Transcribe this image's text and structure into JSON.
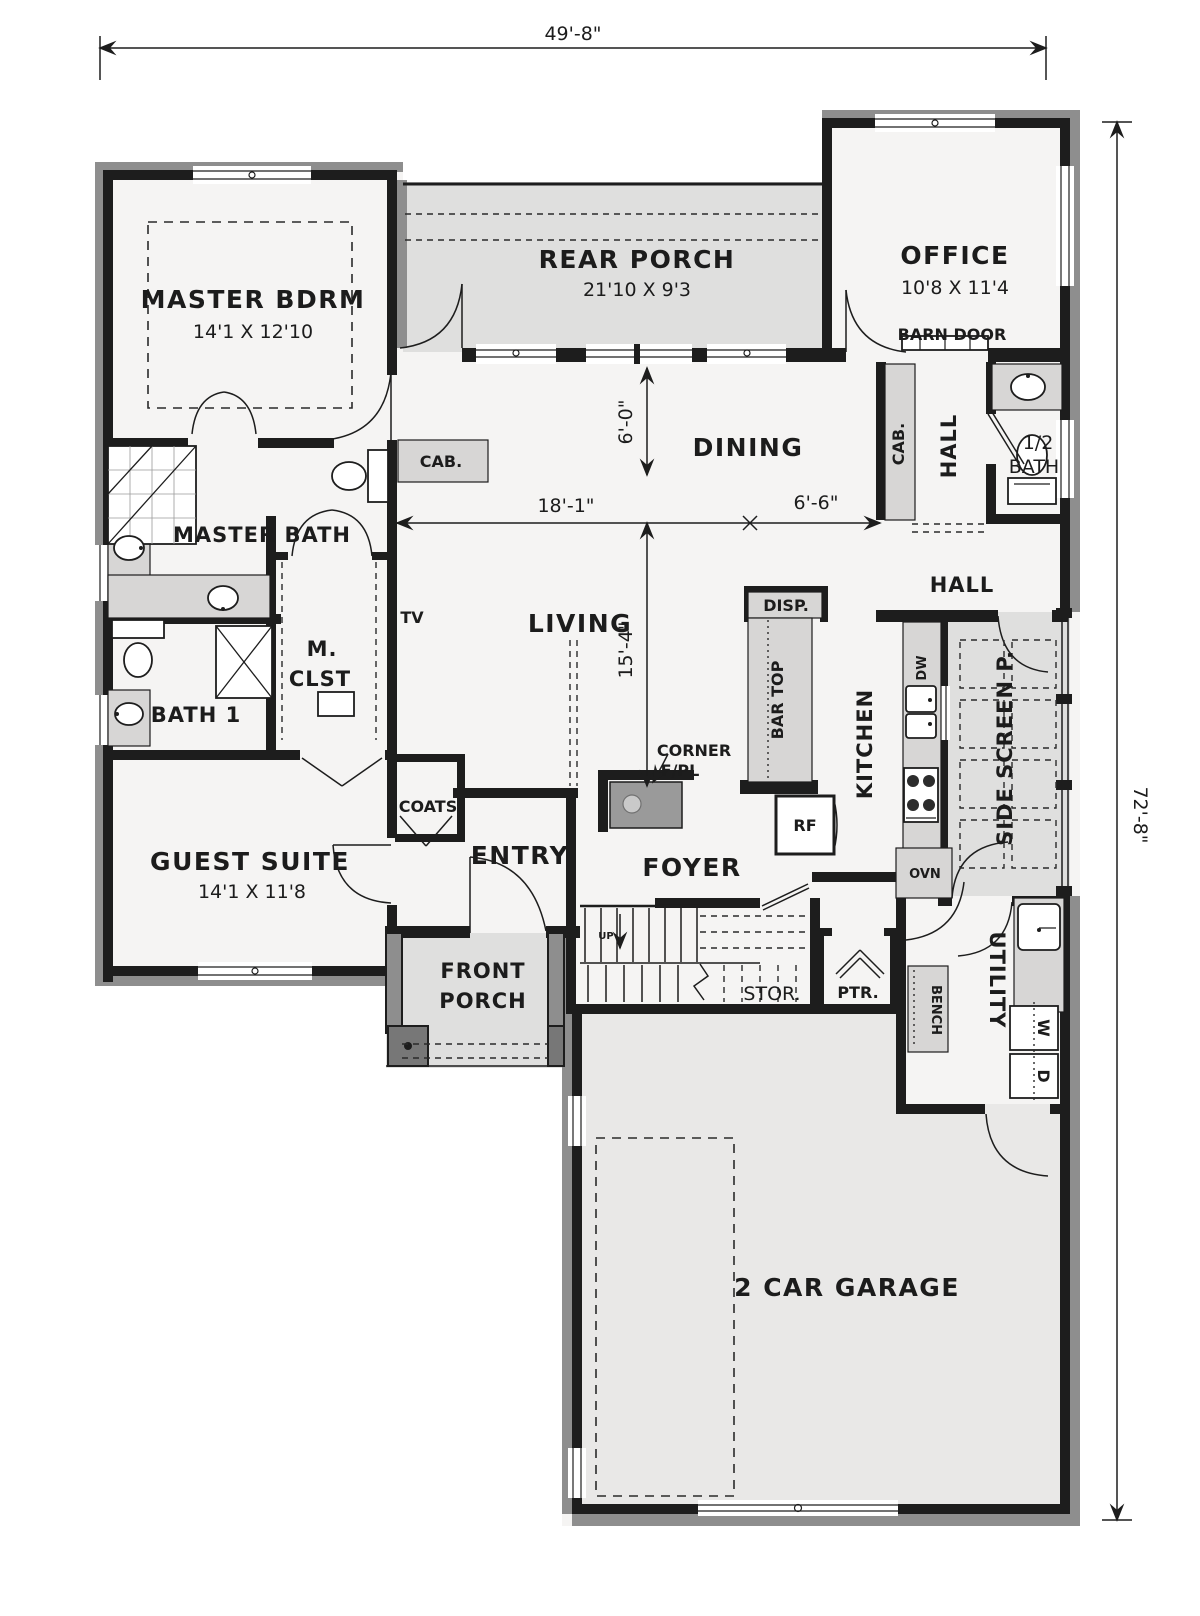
{
  "plan": {
    "dims": {
      "overall_width": "49'-8\"",
      "overall_height": "72'-8\"",
      "dining_depth": "6'-0\"",
      "living_width": "18'-1\"",
      "dining_width": "6'-6\"",
      "living_depth": "15'-4\""
    },
    "rooms": {
      "master_bdrm": {
        "name": "MASTER BDRM",
        "size": "14'1 X 12'10"
      },
      "rear_porch": {
        "name": "REAR PORCH",
        "size": "21'10 X 9'3"
      },
      "office": {
        "name": "OFFICE",
        "size": "10'8 X 11'4"
      },
      "master_bath": {
        "name": "MASTER BATH"
      },
      "master_closet": {
        "line1": "M.",
        "line2": "CLST"
      },
      "bath_1": {
        "name": "BATH 1"
      },
      "guest_suite": {
        "name": "GUEST SUITE",
        "size": "14'1 X 11'8"
      },
      "dining": {
        "name": "DINING"
      },
      "living": {
        "name": "LIVING"
      },
      "hall_back": {
        "name": "HALL"
      },
      "half_bath": {
        "line1": "1/2",
        "line2": "BATH"
      },
      "hall_side": {
        "name": "HALL"
      },
      "kitchen": {
        "name": "KITCHEN"
      },
      "side_screen_porch": {
        "name": "SIDE SCREEN P."
      },
      "entry": {
        "name": "ENTRY"
      },
      "foyer": {
        "name": "FOYER"
      },
      "front_porch": {
        "line1": "FRONT",
        "line2": "PORCH"
      },
      "storage": {
        "name": "STOR."
      },
      "pantry": {
        "name": "PTR."
      },
      "utility": {
        "name": "UTILITY"
      },
      "garage": {
        "name": "2 CAR GARAGE"
      }
    },
    "callouts": {
      "barn_door": "BARN DOOR",
      "cab": "CAB.",
      "tv": "TV",
      "corner_fpl_line1": "CORNER",
      "corner_fpl_line2": "F/PL",
      "coats": "COATS",
      "disp": "DISP.",
      "bar_top": "BAR TOP",
      "fridge": "RF",
      "dishwasher": "DW",
      "oven": "OVN",
      "bench": "BENCH",
      "washer": "W",
      "dryer": "D",
      "up": "UP"
    },
    "colors": {
      "wall": "#1d1d1d",
      "exterior_band": "#8e8e8e",
      "interior_floor": "#f5f4f3",
      "porch_floor": "#dfdfde",
      "garage_floor": "#e9e8e7",
      "counter": "#d7d6d5",
      "text": "#1c1c1c"
    }
  }
}
